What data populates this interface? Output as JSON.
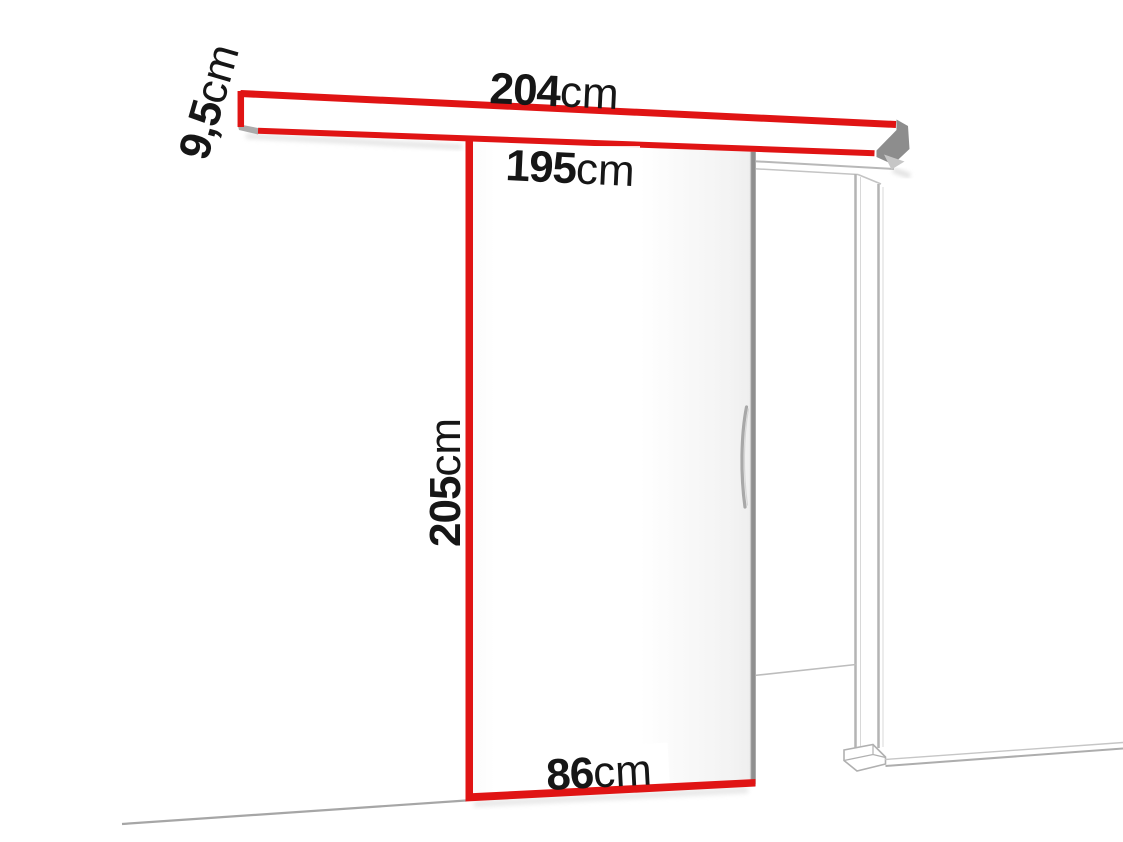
{
  "colors": {
    "accent_red": "#e01414",
    "line_gray": "#b4b4b4",
    "edge_dark_gray": "#8d8d8d",
    "text_black": "#161616"
  },
  "diagram": {
    "kind": "sliding-door-dimension-diagram",
    "dimensions": {
      "rail_length": {
        "value": "204",
        "unit": "cm"
      },
      "rail_height": {
        "value": "9,5",
        "unit": "cm"
      },
      "opening_width": {
        "value": "195",
        "unit": "cm"
      },
      "door_height": {
        "value": "205",
        "unit": "cm"
      },
      "door_width": {
        "value": "86",
        "unit": "cm"
      }
    }
  }
}
